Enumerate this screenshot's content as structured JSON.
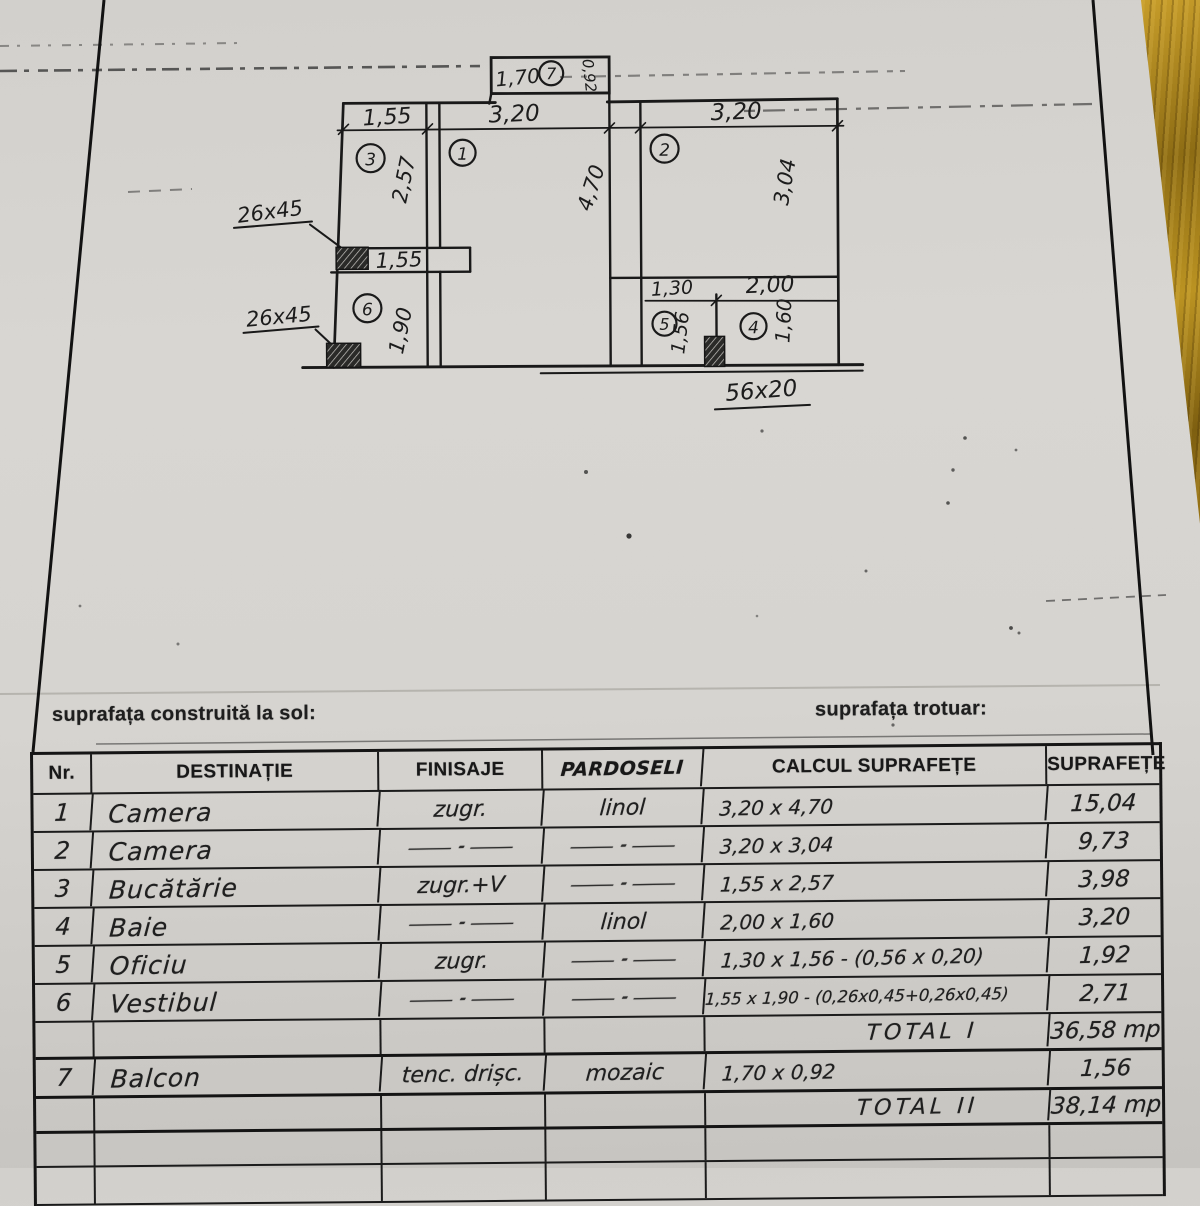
{
  "captions": {
    "left": "suprafața construită la sol:",
    "right": "suprafața trotuar:"
  },
  "plan": {
    "balcony": {
      "width": "1,70",
      "number": "7",
      "depth": "0,92"
    },
    "top_dims": {
      "d1": "1,55",
      "d2": "3,20",
      "d3": "3,20"
    },
    "rooms": {
      "r1": {
        "no": "1",
        "h": "4,70"
      },
      "r2": {
        "no": "2",
        "h": "3,04"
      },
      "r3": {
        "no": "3",
        "h": "2,57"
      },
      "r4": {
        "no": "4",
        "w": "2,00",
        "h": "1,60"
      },
      "r5": {
        "no": "5",
        "w": "1,30",
        "h": "1,56"
      },
      "r6": {
        "no": "6",
        "h": "1,90"
      }
    },
    "shelf_dim": "1,55",
    "pier_labels": {
      "top": "26x45",
      "bottom": "26x45",
      "right": "56x20"
    }
  },
  "table": {
    "headers": {
      "nr": "Nr.",
      "destinatie": "DESTINAȚIE",
      "finisaje": "FINISAJE",
      "pardoseli": "PARDOSELI",
      "calcul": "CALCUL SUPRAFEȚE",
      "suprafete": "SUPRAFEȚE"
    },
    "rows": [
      {
        "nr": "1",
        "destinatie": "Camera",
        "finisaje": "zugr.",
        "pardoseli": "linol",
        "calcul": "3,20 x 4,70",
        "suprafata": "15,04"
      },
      {
        "nr": "2",
        "destinatie": "Camera",
        "finisaje": "—·—",
        "pardoseli": "—·—",
        "calcul": "3,20 x 3,04",
        "suprafata": "9,73"
      },
      {
        "nr": "3",
        "destinatie": "Bucătărie",
        "finisaje": "zugr.+V",
        "pardoseli": "—·—",
        "calcul": "1,55 x 2,57",
        "suprafata": "3,98"
      },
      {
        "nr": "4",
        "destinatie": "Baie",
        "finisaje": "—·—",
        "pardoseli": "linol",
        "calcul": "2,00 x 1,60",
        "suprafata": "3,20"
      },
      {
        "nr": "5",
        "destinatie": "Oficiu",
        "finisaje": "zugr.",
        "pardoseli": "—·—",
        "calcul": "1,30 x 1,56 - (0,56 x 0,20)",
        "suprafata": "1,92"
      },
      {
        "nr": "6",
        "destinatie": "Vestibul",
        "finisaje": "—·—",
        "pardoseli": "—·—",
        "calcul": "1,55 x 1,90 - (0,26x0,45+0,26x0,45)",
        "suprafata": "2,71"
      }
    ],
    "total1": {
      "label": "TOTAL I",
      "value": "36,58 mp"
    },
    "balcon": {
      "nr": "7",
      "destinatie": "Balcon",
      "finisaje": "tenc. drișc.",
      "pardoseli": "mozaic",
      "calcul": "1,70 x 0,92",
      "suprafata": "1,56"
    },
    "total2": {
      "label": "TOTAL II",
      "value": "38,14 mp"
    }
  }
}
